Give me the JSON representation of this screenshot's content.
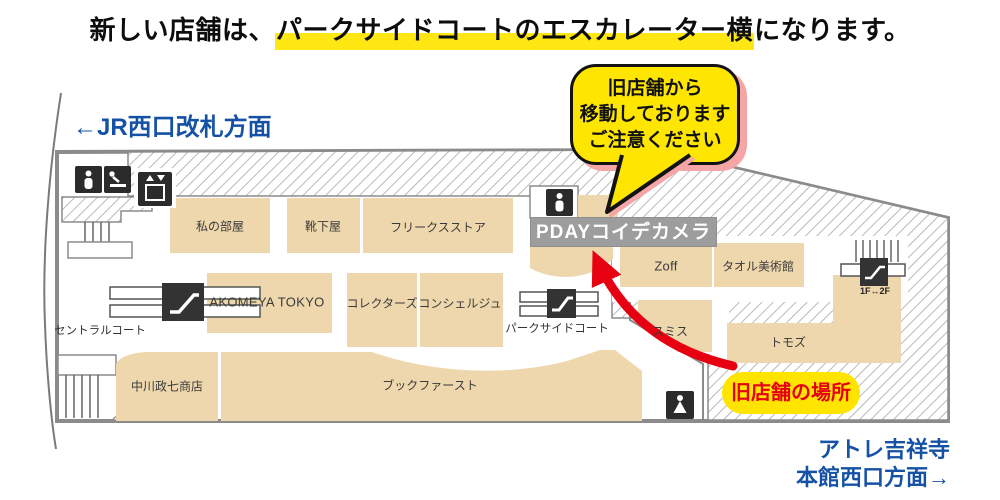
{
  "title": {
    "prefix": "新しい店舗は、",
    "highlight": "パークサイドコートのエスカレーター横",
    "suffix": "になります。"
  },
  "callout": {
    "line1": "旧店舗から",
    "line2": "移動しております",
    "line3": "ご注意ください"
  },
  "directions": {
    "jr_west": "←JR西口改札方面",
    "atre_line1": "アトレ吉祥寺",
    "atre_line2": "本館西口方面→"
  },
  "map": {
    "new_store_sign": "PDAYコイデカメラ",
    "old_store_badge": "旧店舗の場所",
    "stores": [
      "私の部屋",
      "靴下屋",
      "フリークスストア",
      "AKOMEYA TOKYO",
      "コレクターズ",
      "コンシェルジュ",
      "中川政七商店",
      "ブックファースト",
      "Zoff",
      "タオル美術館",
      "スミス",
      "トモズ"
    ],
    "courts": {
      "central": "セントラルコート",
      "parkside": "パークサイドコート"
    },
    "escalator_floor_label": "1F↔2F",
    "icons": [
      "toilet-icon",
      "baby-changing-icon",
      "elevator-icon",
      "escalator-icon",
      "stairs-icon",
      "male-toilet-icon",
      "female-toilet-icon"
    ],
    "colors": {
      "highlight_yellow": "#ffe714",
      "bubble_yellow": "#ffe600",
      "badge_yellow": "#ffe400",
      "store_beige": "#efd7ad",
      "wall_gray": "#8b8b8b",
      "sign_gray": "#9d9d9d",
      "accent_red": "#e60012",
      "direction_blue": "#1552a5",
      "shadow_pink": "#f5a5a5"
    }
  }
}
